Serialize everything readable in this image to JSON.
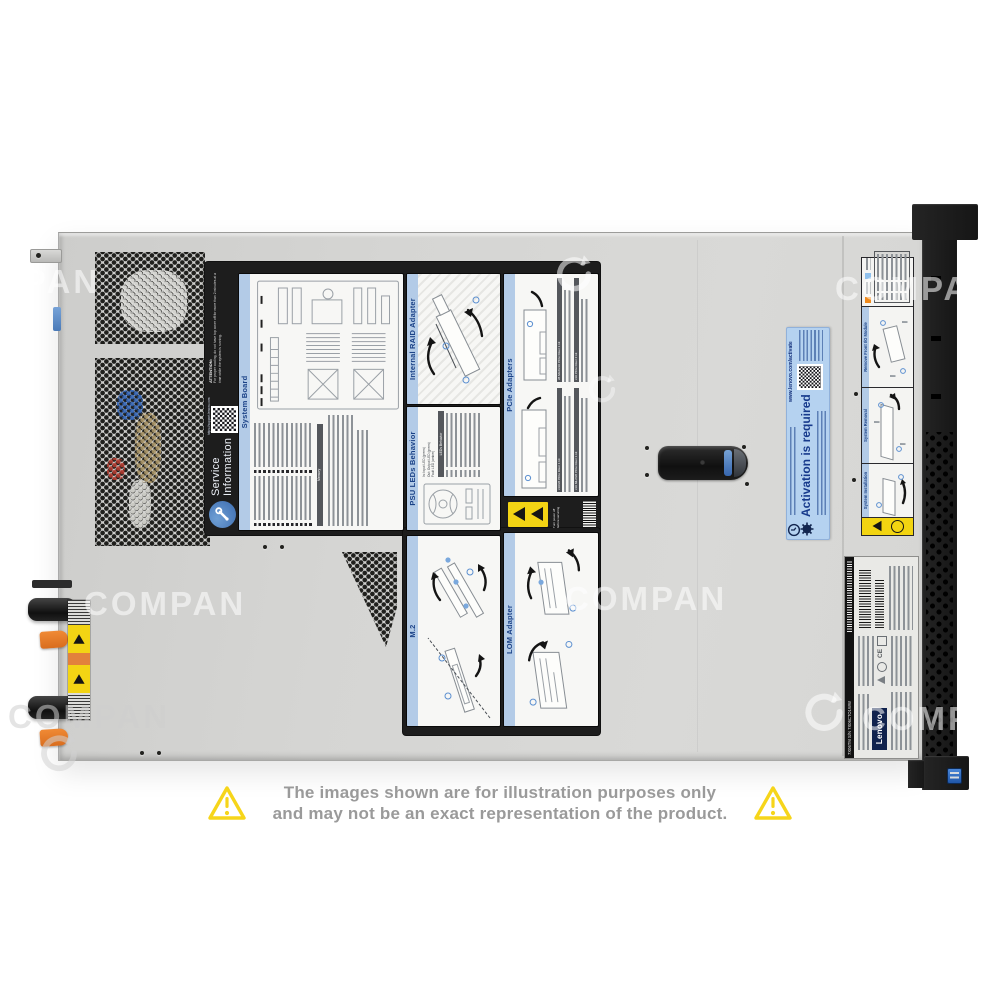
{
  "watermark": {
    "text": "COMPAN"
  },
  "disclaimer": {
    "line1": "The images shown are for illustration purposes only",
    "line2": "and may not be an exact representation of the product."
  },
  "service_label": {
    "logo_title_line1": "Service",
    "logo_title_line2": "Information",
    "attention_heading": "ATTENTION:",
    "attention_body": "For proper cooling, do not have top cover off for more than 2 minutes at a time while the system is running.",
    "support_url": "https://support.lenovo.com",
    "sections": {
      "system_board": "System Board",
      "memory_header": "Memory",
      "internal_raid": "Internal RAID Adapter",
      "pcie_adapters": "PCIe Adapters",
      "psu_leds": "PSU LEDs Behavior",
      "leds_table_header": "LEDs Behavior",
      "m2": "M.2",
      "lom": "LOM Adapter"
    },
    "pcie_risers": [
      "x16/x8 PCIe Riser 1 kit",
      "x8 ML2/x16 PCIe Riser 1 kit",
      "x16 ML2/x8 PCIe Riser 1 kit",
      "x16 PCIe Riser 2 kit"
    ],
    "psu_legend": [
      "In: Input LED (green)",
      "Out: Output LED (green)",
      "Fault LED (amber)"
    ],
    "warning_note": "Turn power off before servicing"
  },
  "activation_label": {
    "title": "Activation is required",
    "url": "www.lenovo.com/activate"
  },
  "rail_label": {
    "sections": [
      "Remove Front I/O Module",
      "System Removal",
      "System Installation"
    ]
  },
  "rating_label": {
    "brand": "Lenovo",
    "ce_mark": "CE",
    "serial_strip": "7X06TM S/N 7X06CTO1WW"
  }
}
